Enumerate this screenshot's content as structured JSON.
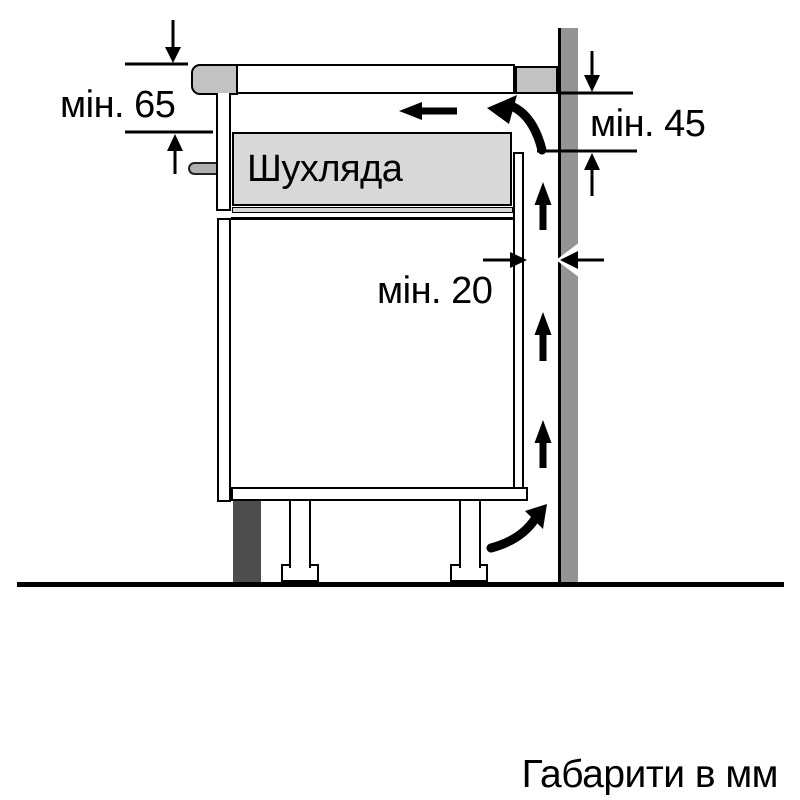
{
  "diagram": {
    "caption": "Габарити в мм",
    "drawer_label": "Шухляда",
    "dimensions": [
      {
        "id": "min-65",
        "label": "мін. 65",
        "value": 65,
        "unit": "мм"
      },
      {
        "id": "min-45",
        "label": "мін. 45",
        "value": 45,
        "unit": "мм"
      },
      {
        "id": "min-20",
        "label": "мін. 20",
        "value": 20,
        "unit": "мм"
      }
    ],
    "colors": {
      "background": "#ffffff",
      "wall": "#949494",
      "worktop_trim": "#c2c2c2",
      "drawer_fill": "#d8d8d8",
      "plinth": "#4d4d4d",
      "fixing_pin": "#b0b0b0",
      "line": "#000000"
    }
  }
}
